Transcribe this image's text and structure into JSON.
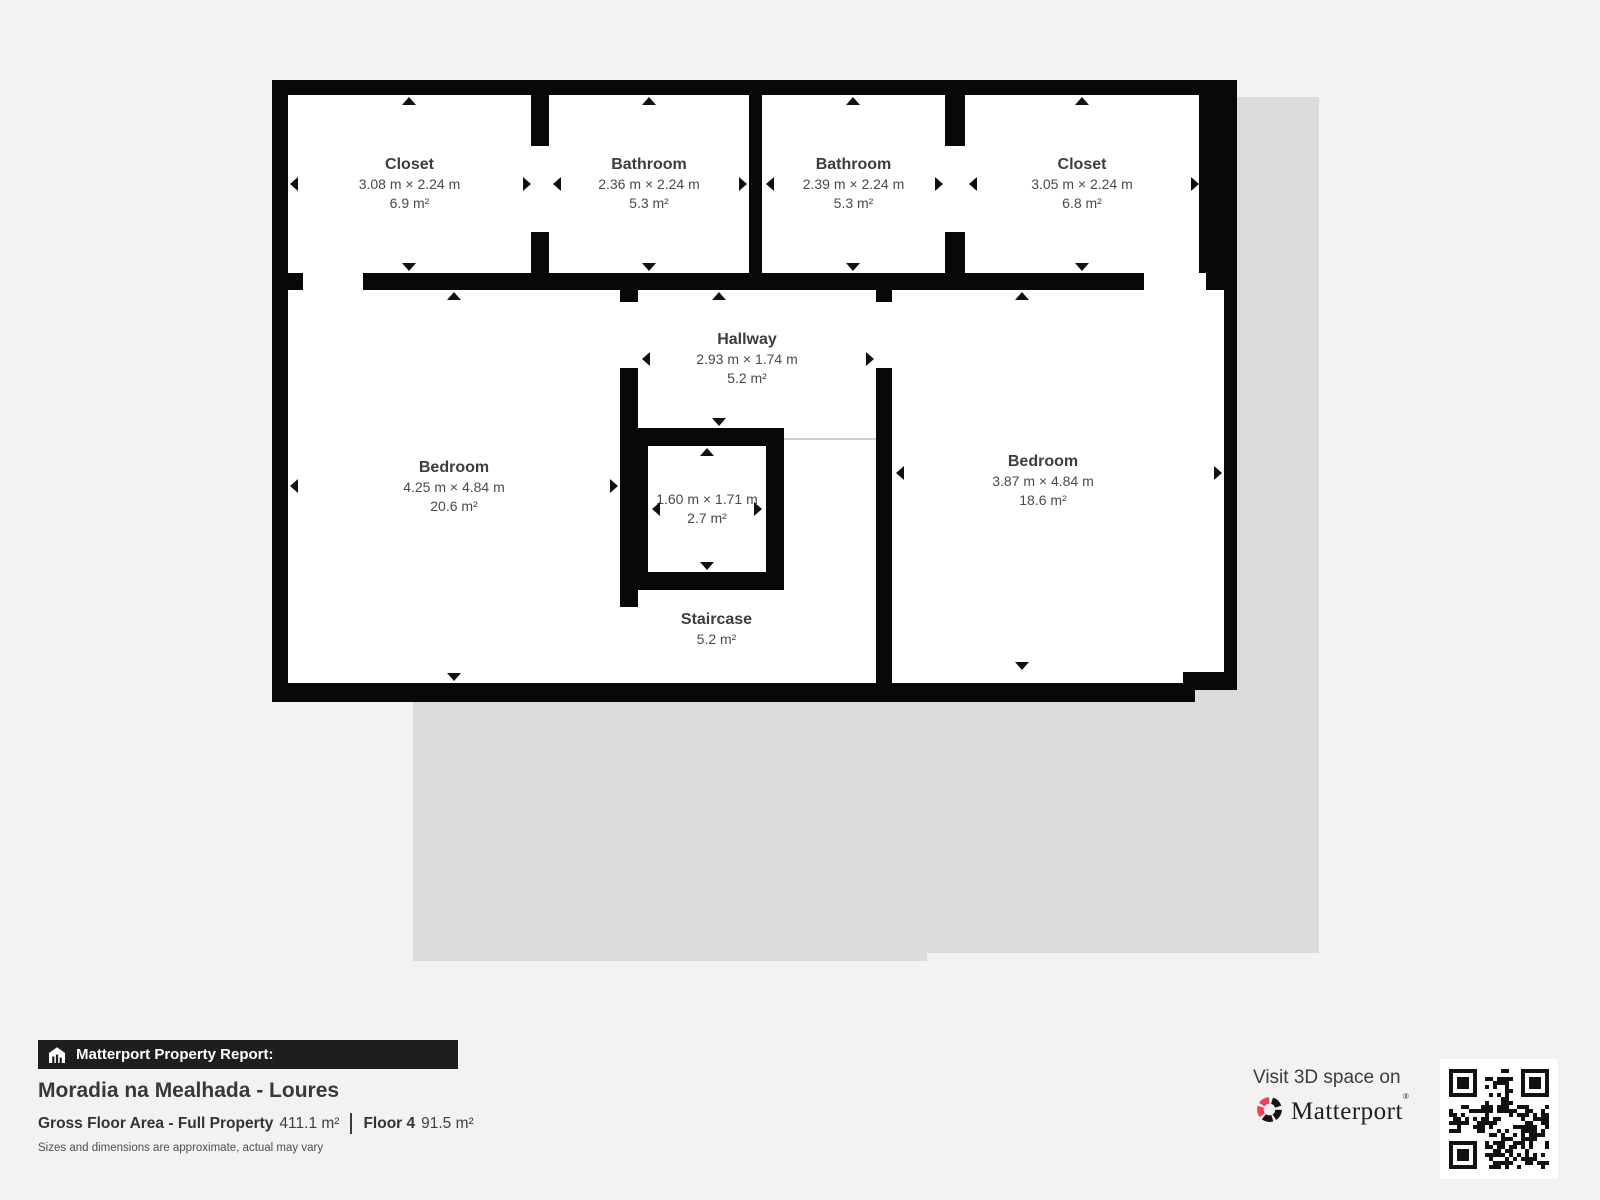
{
  "plan": {
    "rooms": [
      {
        "id": "closet-top-left",
        "name": "Closet",
        "dims": "3.08 m × 2.24 m",
        "area": "6.9 m²"
      },
      {
        "id": "bathroom-left",
        "name": "Bathroom",
        "dims": "2.36 m × 2.24 m",
        "area": "5.3 m²"
      },
      {
        "id": "bathroom-right",
        "name": "Bathroom",
        "dims": "2.39 m × 2.24 m",
        "area": "5.3 m²"
      },
      {
        "id": "closet-top-right",
        "name": "Closet",
        "dims": "3.05 m × 2.24 m",
        "area": "6.8 m²"
      },
      {
        "id": "hallway",
        "name": "Hallway",
        "dims": "2.93 m × 1.74 m",
        "area": "5.2 m²"
      },
      {
        "id": "bedroom-left",
        "name": "Bedroom",
        "dims": "4.25 m × 4.84 m",
        "area": "20.6 m²"
      },
      {
        "id": "small-closet",
        "name": "",
        "dims": "1.60 m × 1.71 m",
        "area": "2.7 m²"
      },
      {
        "id": "bedroom-right",
        "name": "Bedroom",
        "dims": "3.87 m × 4.84 m",
        "area": "18.6 m²"
      },
      {
        "id": "staircase",
        "name": "Staircase",
        "dims": "",
        "area": "5.2 m²"
      }
    ]
  },
  "report": {
    "banner_label": "Matterport Property Report:",
    "property_title": "Moradia na Mealhada - Loures",
    "gfa_label": "Gross Floor Area - Full Property",
    "gfa_value": "411.1 m²",
    "floor_label": "Floor 4",
    "floor_value": "91.5 m²",
    "disclaimer": "Sizes and dimensions are approximate, actual may vary"
  },
  "cta": {
    "visit_text": "Visit 3D space on",
    "brand": "Matterport",
    "icons": [
      "matterport-pinwheel-icon",
      "house-report-icon",
      "qr-code"
    ]
  },
  "colors": {
    "background": "#f3f2f0",
    "underlay_gray": "#dbdbdb",
    "wall_black": "#080808",
    "accent_pink": "#f43e5c",
    "banner_bg": "#1e1e1e"
  }
}
